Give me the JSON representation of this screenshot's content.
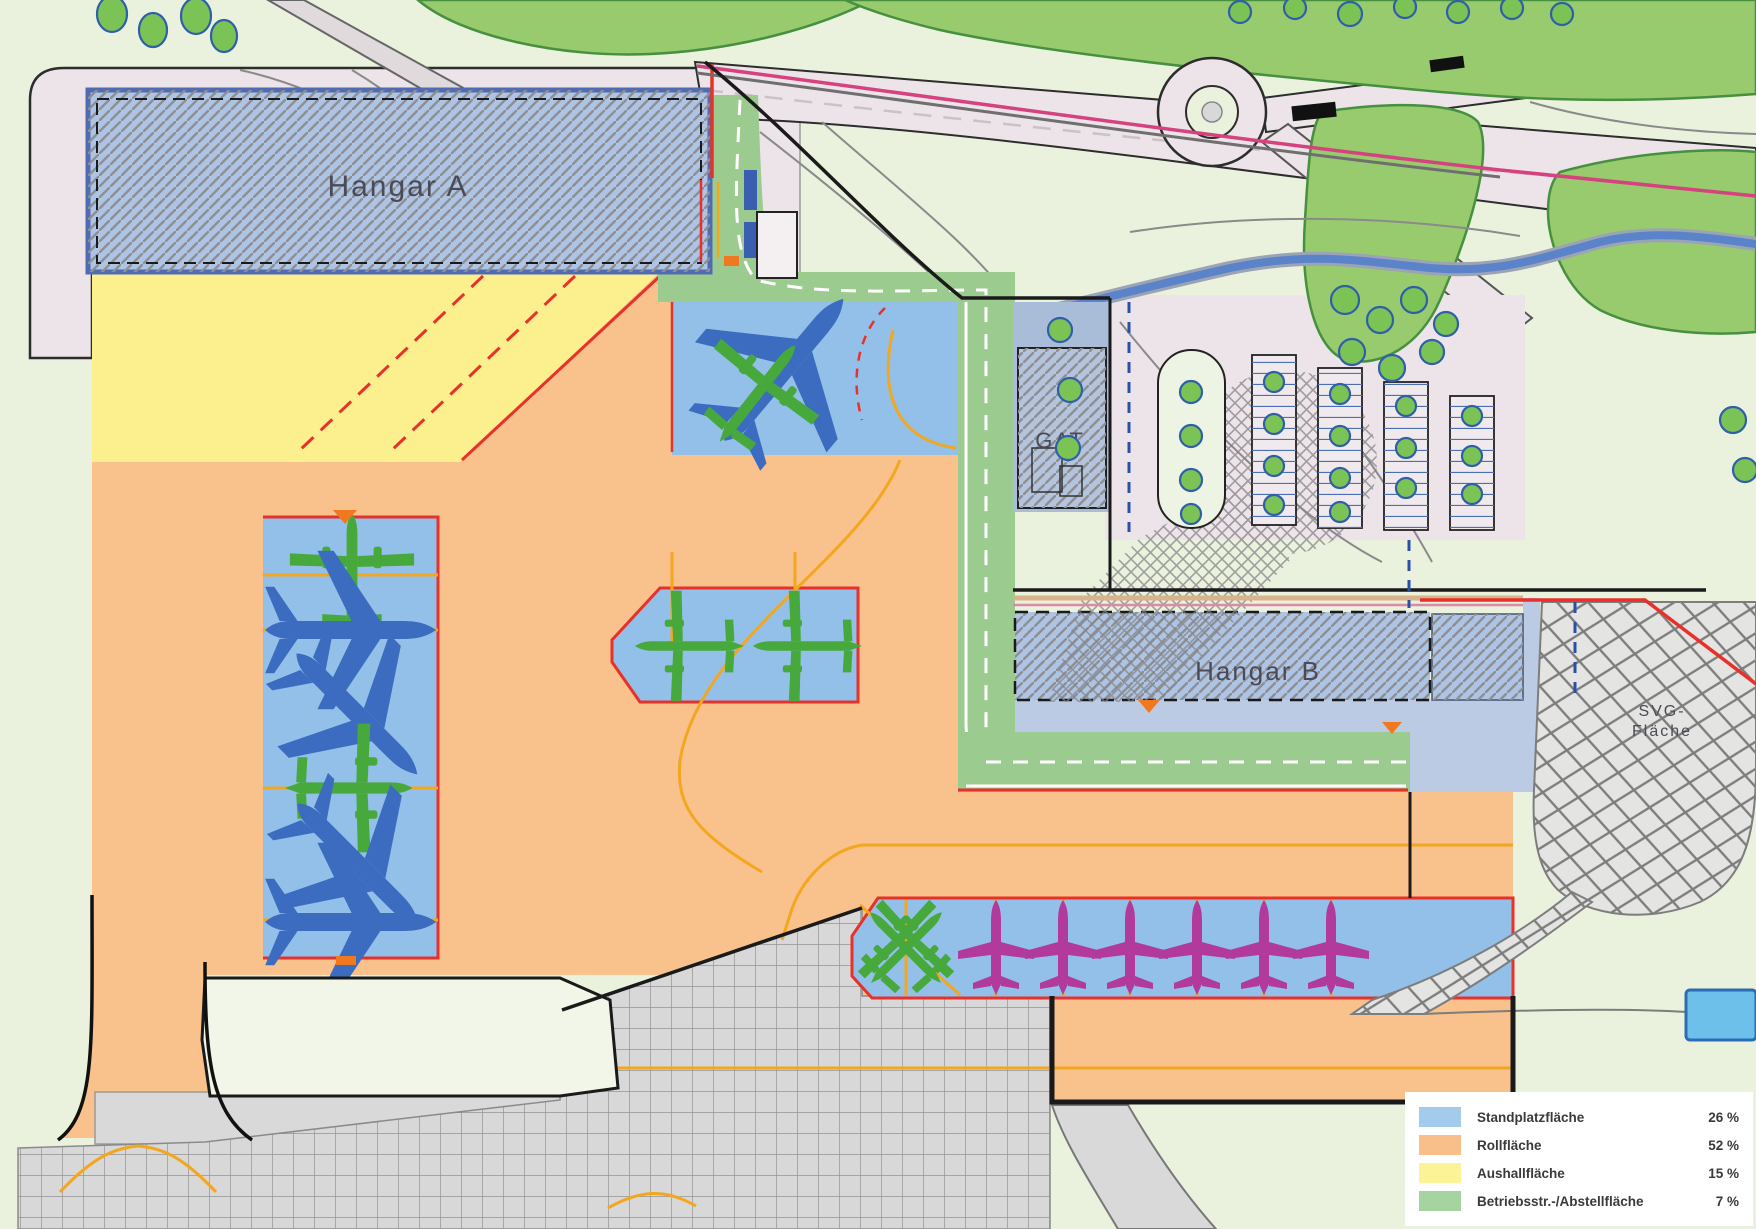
{
  "map": {
    "labels": {
      "hangar_a": "Hangar A",
      "hangar_b": "Hangar B",
      "gat": "GAT",
      "svg_area_line1": "SVG-",
      "svg_area_line2": "Fläche"
    }
  },
  "legend": {
    "items": [
      {
        "label": "Standplatzfläche",
        "value": "26 %",
        "color": "#a3cbec"
      },
      {
        "label": "Rollfläche",
        "value": "52 %",
        "color": "#f9bf8a"
      },
      {
        "label": "Aushallfläche",
        "value": "15 %",
        "color": "#fbf395"
      },
      {
        "label": "Betriebsstr.-/Abstellfläche",
        "value": "7 %",
        "color": "#a6d4a0"
      }
    ]
  },
  "colors": {
    "stand_blue": "#92c0e8",
    "roll_orange": "#f9c18c",
    "aushall_yellow": "#fbf08d",
    "betrieb_green": "#9ccb8f",
    "hangar_fill": "#adc4e4",
    "boundary_red": "#e8312a",
    "taxi_yellow": "#f2a71f"
  }
}
